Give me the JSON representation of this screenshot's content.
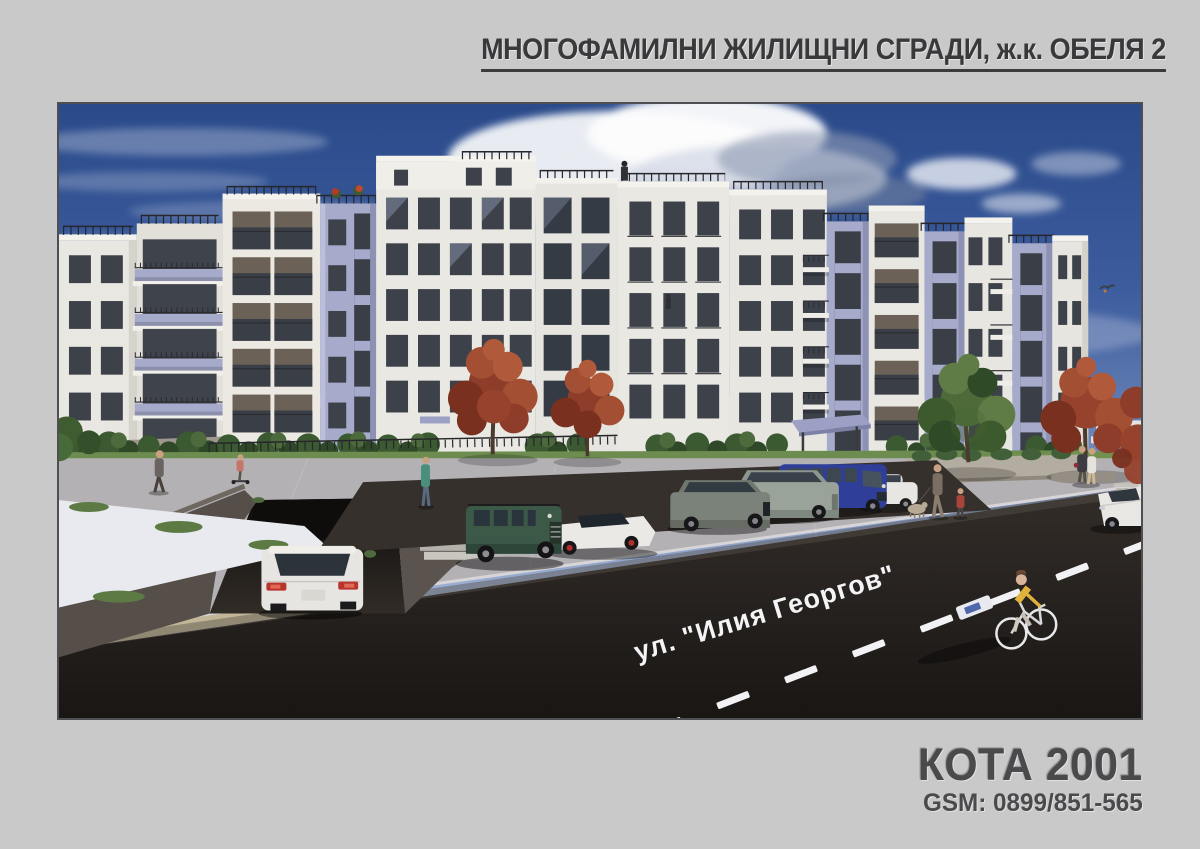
{
  "page": {
    "background_color": "#c9c9c9",
    "title": "МНОГОФАМИЛНИ ЖИЛИЩНИ СГРАДИ, ж.к. ОБЕЛЯ 2"
  },
  "footer": {
    "company_name": "КОТА 2001",
    "phone": "GSM: 0899/851-565"
  },
  "rendering": {
    "type": "architectural-3d-visualization",
    "street_label": "ул. \"Илия Георгов\"",
    "colors": {
      "sky_top": "#2a4a8a",
      "sky_horizon": "#c3cde2",
      "facade_white": "#eae8e2",
      "facade_accent_lavender": "#a6aacb",
      "window_glass": "#3d414a",
      "asphalt_road": "#262220",
      "pavement": "#b4b1b5",
      "curb_stone": "#c2b698",
      "autumn_tree": "#9c4530",
      "green_tree": "#4e6a39",
      "grass": "#6d8c4f",
      "road_marking": "#f2f2f4"
    },
    "scene": {
      "building": "six-storey white apartment complex with lavender bay accents, balconies and roof terraces",
      "vehicles": [
        "white hatchback on underground-garage ramp",
        "green SUV",
        "white sports car",
        "grey hatchback",
        "grey estate car",
        "blue delivery van",
        "white sedan",
        "white car at right road edge"
      ],
      "people": [
        "pedestrian walking on left path",
        "child with scooter",
        "person near garage stairs",
        "man walking dog with child",
        "couple on right sidewalk",
        "cyclist in yellow shirt",
        "residents on roof terrace and balconies"
      ],
      "landscape": [
        "two red ornamental trees",
        "green tree",
        "red tree at right edge",
        "trimmed hedges",
        "lawn strips"
      ],
      "road_markings": [
        "dashed white centre line",
        "cycle lane marker"
      ]
    }
  }
}
